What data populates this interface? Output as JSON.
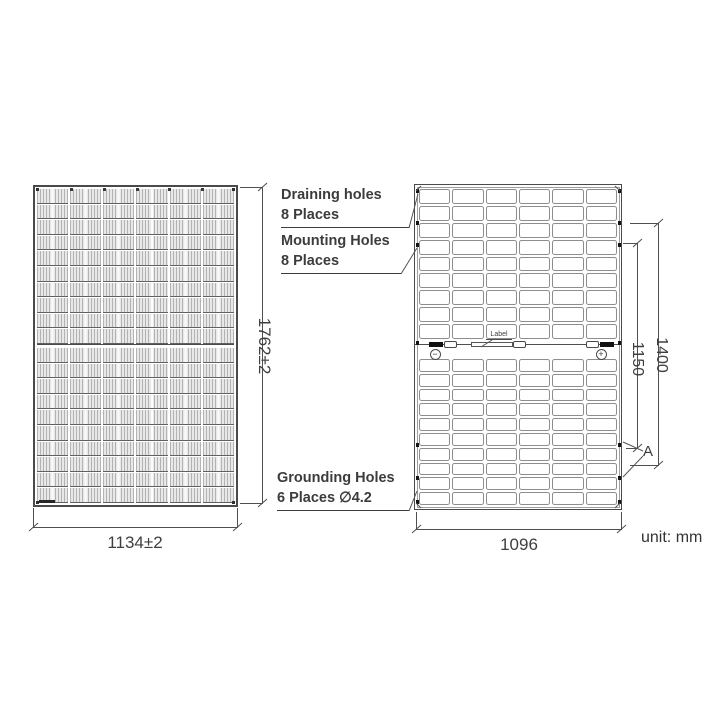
{
  "unit_label": "unit: mm",
  "front_view": {
    "columns": 6,
    "rows_per_half": 10,
    "width_dim": "1134±2",
    "height_dim": "1762±2"
  },
  "back_view": {
    "columns": 6,
    "rows_top": 9,
    "rows_bottom": 10,
    "width_dim": "1096",
    "inner_height_dim": "1150",
    "outer_height_dim": "1400",
    "section_marker": "A",
    "junction": {
      "label_text": "Label",
      "negative_symbol": "−",
      "positive_symbol": "+"
    }
  },
  "callouts": {
    "draining": {
      "line1": "Draining holes",
      "line2": "8 Places"
    },
    "mounting": {
      "line1": "Mounting Holes",
      "line2": "8 Places"
    },
    "grounding": {
      "line1": "Grounding Holes",
      "line2": "6 Places ∅4.2"
    }
  }
}
